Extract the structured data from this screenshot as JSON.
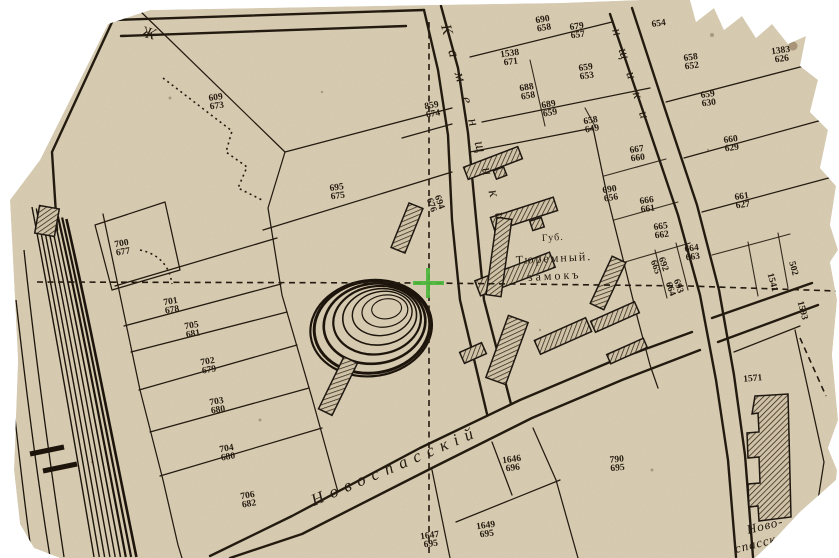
{
  "map": {
    "kind": "historical-cadastral-map-scan",
    "colors": {
      "paper": "#d8ccb2",
      "ink": "#241b10",
      "cursor_green": "#4db83c",
      "stain": "#6b4d2e"
    },
    "cursor_marker": {
      "x": 428,
      "y": 283,
      "color": "#4db83c"
    },
    "place_labels": {
      "prison_line1": "Губ.",
      "prison_line2": "Тюремный.",
      "prison_line3": "замокъ",
      "street_left": "Каменщики",
      "street_right_partial": "нщики",
      "street_bottom": "Новоспасскій",
      "corner_label_line1": "Ново-",
      "corner_label_line2": "спасск",
      "top_street_partial": "Ж"
    },
    "text_labels": [
      {
        "name": "street-kamenshchiki",
        "text": "Каменщики",
        "x": 441,
        "y": 26,
        "rot": 74,
        "size": 15,
        "ls": 16,
        "italic": true
      },
      {
        "name": "street-kamenshchiki-right",
        "text": "нщики",
        "x": 612,
        "y": 30,
        "rot": 72,
        "size": 14,
        "ls": 14,
        "italic": true
      },
      {
        "name": "street-novospassky",
        "text": "Новоспасскій",
        "x": 314,
        "y": 506,
        "rot": -23,
        "size": 17,
        "ls": 7,
        "italic": true
      },
      {
        "name": "label-novo",
        "text": "Ново-",
        "x": 748,
        "y": 534,
        "rot": -14,
        "size": 13,
        "ls": 1,
        "italic": true
      },
      {
        "name": "label-spassk",
        "text": "спасск",
        "x": 736,
        "y": 553,
        "rot": -14,
        "size": 13,
        "ls": 1,
        "italic": true
      },
      {
        "name": "label-gub",
        "text": "Губ.",
        "x": 542,
        "y": 241,
        "rot": -3,
        "size": 10,
        "ls": 1,
        "italic": false
      },
      {
        "name": "label-tyuremny",
        "text": "Тюремный.",
        "x": 516,
        "y": 264,
        "rot": -3,
        "size": 12,
        "ls": 2,
        "italic": false
      },
      {
        "name": "label-zamok",
        "text": "замокъ",
        "x": 528,
        "y": 281,
        "rot": -3,
        "size": 12,
        "ls": 3,
        "italic": false
      },
      {
        "name": "label-zh",
        "text": "Ж",
        "x": 140,
        "y": 36,
        "rot": 15,
        "size": 16,
        "ls": 0,
        "italic": true
      }
    ],
    "plot_labels": [
      {
        "top": "609",
        "bottom": "673",
        "x": 216,
        "y": 100,
        "rot": -8
      },
      {
        "top": "690",
        "bottom": "658",
        "x": 543,
        "y": 22,
        "rot": -10
      },
      {
        "top": "679",
        "bottom": "657",
        "x": 577,
        "y": 29,
        "rot": -8
      },
      {
        "top": "1538",
        "bottom": "671",
        "x": 510,
        "y": 56,
        "rot": -8
      },
      {
        "top": "654",
        "bottom": "",
        "x": 659,
        "y": 26,
        "rot": -8
      },
      {
        "top": "1383",
        "bottom": "626",
        "x": 781,
        "y": 53,
        "rot": -8
      },
      {
        "top": "659",
        "bottom": "653",
        "x": 586,
        "y": 70,
        "rot": -8
      },
      {
        "top": "658",
        "bottom": "652",
        "x": 691,
        "y": 60,
        "rot": -8
      },
      {
        "top": "688",
        "bottom": "658",
        "x": 527,
        "y": 90,
        "rot": -10
      },
      {
        "top": "689",
        "bottom": "659",
        "x": 549,
        "y": 107,
        "rot": -10
      },
      {
        "top": "659",
        "bottom": "630",
        "x": 708,
        "y": 97,
        "rot": -8
      },
      {
        "top": "658",
        "bottom": "649",
        "x": 591,
        "y": 123,
        "rot": -10
      },
      {
        "top": "660",
        "bottom": "629",
        "x": 731,
        "y": 142,
        "rot": -8
      },
      {
        "top": "667",
        "bottom": "660",
        "x": 637,
        "y": 152,
        "rot": -8
      },
      {
        "top": "661",
        "bottom": "627",
        "x": 742,
        "y": 199,
        "rot": -8
      },
      {
        "top": "690",
        "bottom": "656",
        "x": 610,
        "y": 192,
        "rot": -10
      },
      {
        "top": "666",
        "bottom": "661",
        "x": 647,
        "y": 203,
        "rot": -8
      },
      {
        "top": "665",
        "bottom": "662",
        "x": 661,
        "y": 229,
        "rot": -8
      },
      {
        "top": "664",
        "bottom": "663",
        "x": 692,
        "y": 251,
        "rot": -8
      },
      {
        "top": "692",
        "bottom": "665",
        "x": 661,
        "y": 265,
        "rot": 70
      },
      {
        "top": "693",
        "bottom": "664",
        "x": 676,
        "y": 287,
        "rot": 70
      },
      {
        "top": "1541",
        "bottom": "",
        "x": 770,
        "y": 283,
        "rot": 75
      },
      {
        "top": "502",
        "bottom": "",
        "x": 791,
        "y": 269,
        "rot": 75
      },
      {
        "top": "1593",
        "bottom": "",
        "x": 800,
        "y": 311,
        "rot": 75
      },
      {
        "top": "859",
        "bottom": "674",
        "x": 432,
        "y": 108,
        "rot": -10
      },
      {
        "top": "695",
        "bottom": "675",
        "x": 337,
        "y": 190,
        "rot": -8
      },
      {
        "top": "694",
        "bottom": "676",
        "x": 437,
        "y": 203,
        "rot": 70
      },
      {
        "top": "700",
        "bottom": "677",
        "x": 122,
        "y": 246,
        "rot": -10
      },
      {
        "top": "701",
        "bottom": "678",
        "x": 171,
        "y": 304,
        "rot": -10
      },
      {
        "top": "705",
        "bottom": "681",
        "x": 192,
        "y": 328,
        "rot": -10
      },
      {
        "top": "702",
        "bottom": "679",
        "x": 208,
        "y": 364,
        "rot": -10
      },
      {
        "top": "703",
        "bottom": "680",
        "x": 217,
        "y": 404,
        "rot": -10
      },
      {
        "top": "704",
        "bottom": "680",
        "x": 227,
        "y": 451,
        "rot": -10
      },
      {
        "top": "706",
        "bottom": "682",
        "x": 248,
        "y": 498,
        "rot": -10
      },
      {
        "top": "1647",
        "bottom": "695",
        "x": 430,
        "y": 538,
        "rot": -8
      },
      {
        "top": "1646",
        "bottom": "696",
        "x": 512,
        "y": 462,
        "rot": -8
      },
      {
        "top": "1649",
        "bottom": "695",
        "x": 486,
        "y": 528,
        "rot": -8
      },
      {
        "top": "790",
        "bottom": "695",
        "x": 617,
        "y": 462,
        "rot": -5
      },
      {
        "top": "1571",
        "bottom": "",
        "x": 753,
        "y": 381,
        "rot": -5
      }
    ]
  }
}
